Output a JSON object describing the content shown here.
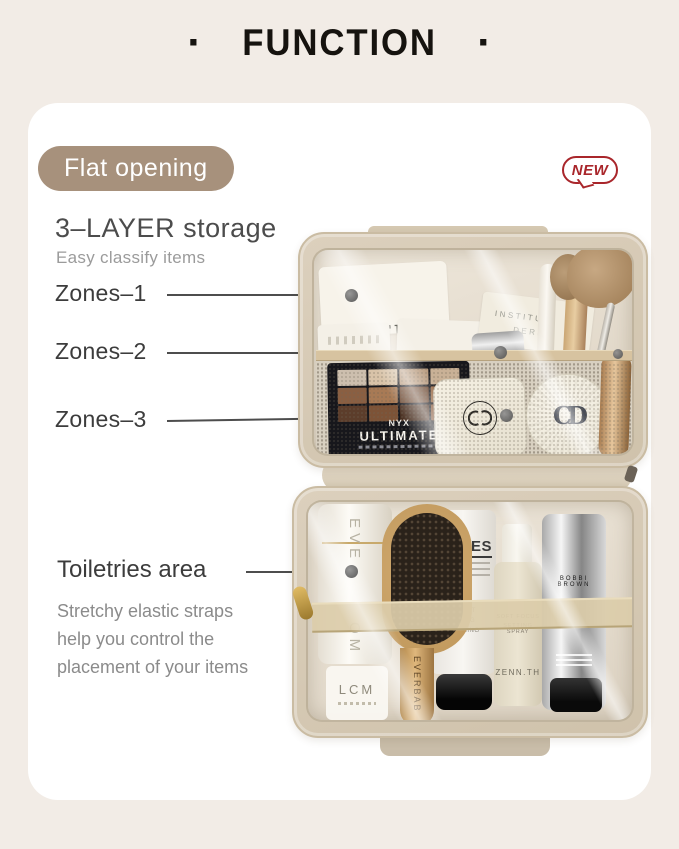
{
  "header": {
    "title": "FUNCTION",
    "title_dot": "·"
  },
  "badges": {
    "flat_opening": "Flat opening",
    "new": "NEW"
  },
  "storage": {
    "heading": "3–LAYER storage",
    "subheading": "Easy classify items"
  },
  "zones": [
    {
      "label": "Zones–1"
    },
    {
      "label": "Zones–2"
    },
    {
      "label": "Zones–3"
    }
  ],
  "toiletries": {
    "heading": "Toiletries area",
    "lines": [
      "Stretchy elastic straps",
      "help you control the",
      "placement of your items"
    ]
  },
  "products": {
    "shero_card": "SHERO",
    "institut_line1": "INSTITUT",
    "institut_line2": "DERM",
    "palette_brand": "NYX",
    "palette_name": "ULTIMATE",
    "roll_vertical_top": "EVE",
    "roll_vertical_bottom": "OM",
    "small_bottle": "LCM",
    "brush_brand": "EVERBAB",
    "tube_name": "SERIES",
    "tube_words": "EXFOLIANT PURIFYING SMOOTHING",
    "spray_line1": "SOFT FOCUS",
    "spray_line2": "SETTING SPRAY",
    "spray_brand": "ZENN.TH",
    "silver_tube_brand": "BOBBI BROWN"
  },
  "icons": {
    "dior_cd": "CD"
  },
  "colors": {
    "background": "#f2ece6",
    "card": "#ffffff",
    "badge_taupe": "#a7917c",
    "new_red": "#a9262b",
    "bag_beige": "#d8ccb8",
    "text_dark": "#3c3c3c",
    "text_gray": "#8b8b8b"
  }
}
